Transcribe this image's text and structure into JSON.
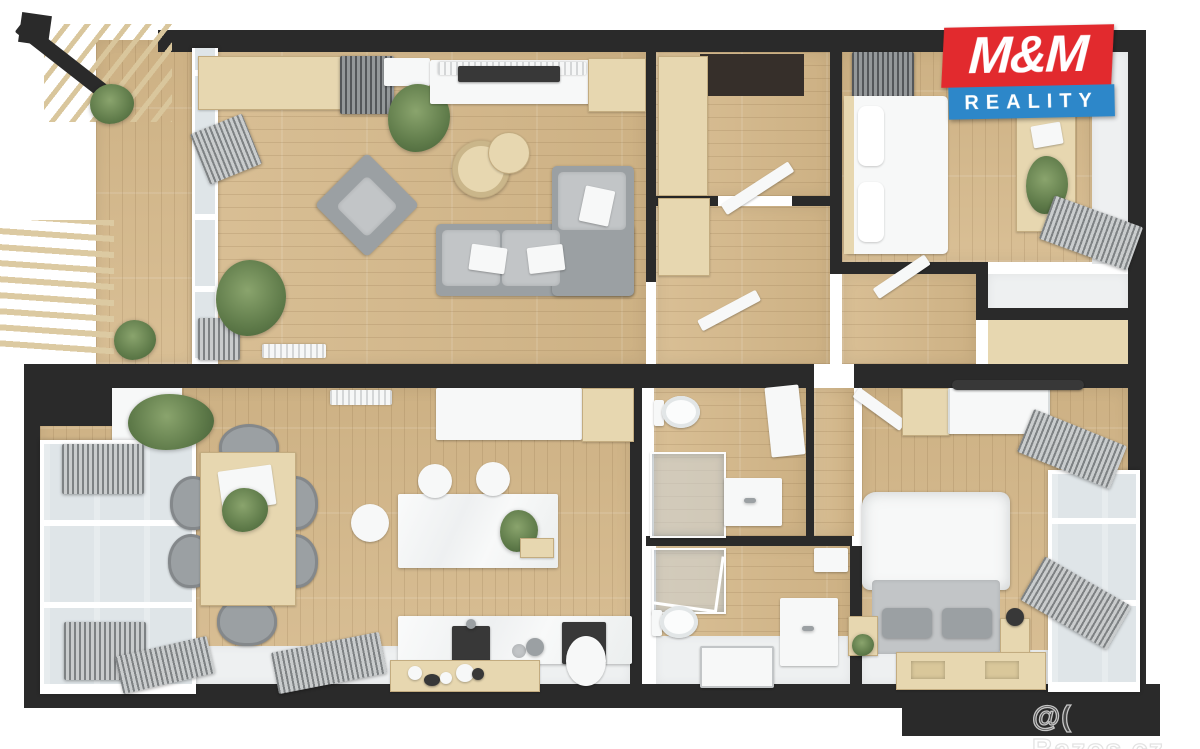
{
  "branding": {
    "logo_line1": "M&M",
    "logo_line2": "REALITY"
  },
  "watermark": {
    "text": "@( Bazos.cz"
  },
  "palette": {
    "bg": "#ffffff",
    "wall": "#2a2a2a",
    "wood_floor": "#d9bf95",
    "wood_floor_dark": "#cdb184",
    "wood_light": "#e7d7b0",
    "tile": "#eef0f1",
    "gray": "#9ba0a3",
    "gray_light": "#c2c5c7",
    "white_furniture": "#f7f8f8",
    "dark_fixture": "#383838",
    "glass": "#dfe5e8",
    "plant_a": "#8aa46d",
    "plant_b": "#5e7a49",
    "logo_red": "#e22a2e",
    "logo_blue": "#2d87c9",
    "entry_dark": "#362f2a"
  }
}
